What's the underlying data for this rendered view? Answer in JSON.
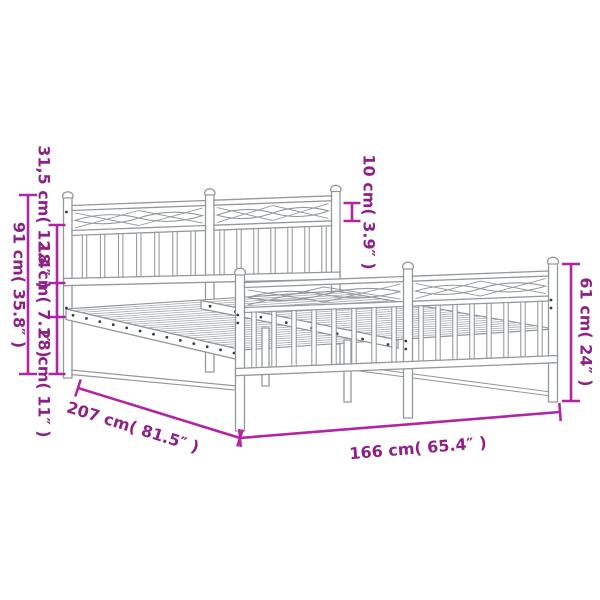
{
  "diagram": {
    "title": "metal-bed-frame-dimension-diagram",
    "background": "#ffffff",
    "colors": {
      "dimension_line": "#b125a3",
      "dimension_text": "#8e2186",
      "drawing_outline": "#94989b"
    },
    "dimensions": {
      "total_height": "91 cm( 35.8″ )",
      "headboard_upper": "31,5 cm( 12.4″ )",
      "headboard_mid": "18 cm( 7.1″ )",
      "base_height": "28 cm( 11″ )",
      "headboard_band": "10 cm( 3.9″ )",
      "footboard_height": "61 cm( 24″ )",
      "length": "207 cm( 81.5″ )",
      "width": "166 cm( 65.4″ )"
    }
  }
}
